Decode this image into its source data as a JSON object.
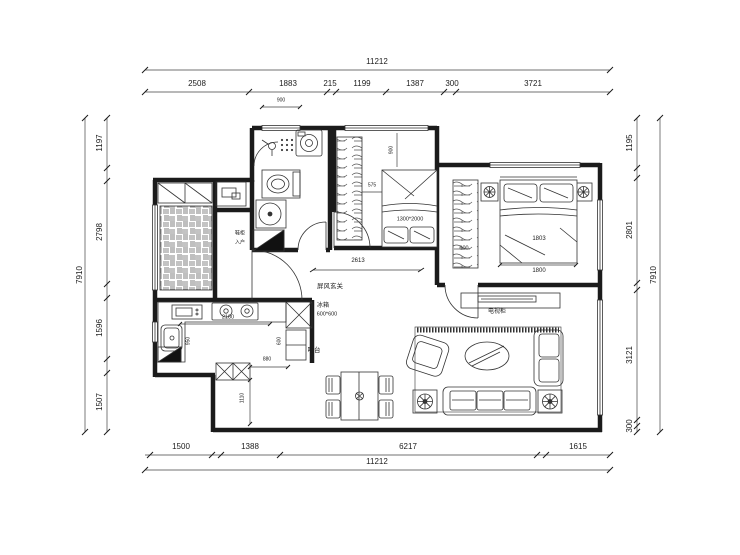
{
  "drawing": {
    "dims": {
      "top": {
        "total": "11212",
        "segments": [
          "2508",
          "1883",
          "215",
          "1199",
          "1387",
          "300",
          "3721"
        ]
      },
      "bottom": {
        "total": "11212",
        "segments": [
          "1500",
          "1388",
          "6217",
          "1615"
        ]
      },
      "left": {
        "total": "7910",
        "segments": [
          "1197",
          "2798",
          "1596",
          "1507"
        ]
      },
      "right": {
        "total": "7910",
        "segments": [
          "1195",
          "2801",
          "3121",
          "300"
        ]
      }
    },
    "labels": {
      "bath_window": "900",
      "bed2_vert": "900",
      "bed2_gap": "575",
      "bed2_size": "1300*2000",
      "hall_width": "2613",
      "screen": "屏风玄关",
      "master_bed": "1803",
      "master_bed_width": "1800",
      "wardrobe": "600",
      "fridge": "冰箱",
      "fridge_size": "600*600",
      "fridge_depth": "600",
      "bar": "吧台",
      "tv_cabinet": "电视柜",
      "counter": "2180",
      "counter_depth": "950",
      "bar_gap": "880",
      "entry_depth": "1110",
      "shoe_cabinet": "鞋柜",
      "entry": "入户"
    },
    "line_color": "#1b1b1b",
    "accent_black": "#111111"
  }
}
